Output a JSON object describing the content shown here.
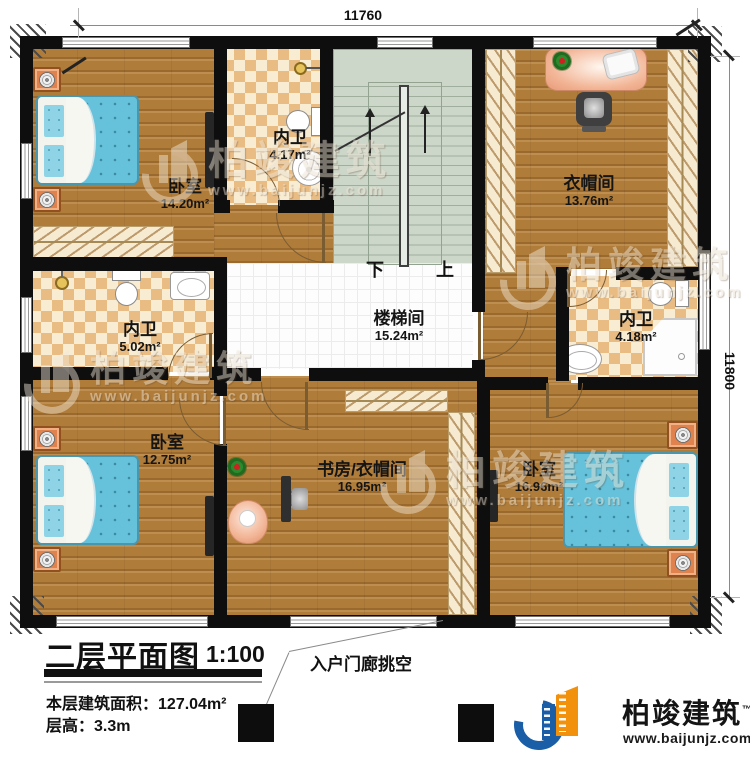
{
  "plan": {
    "title": "二层平面图",
    "scale": "1:100",
    "area_label": "本层建筑面积：",
    "area_value": "127.04m²",
    "floor_height_label": "层高：",
    "floor_height_value": "3.3m",
    "porch_note": "入户门廊挑空",
    "dimensions": {
      "top": "11760",
      "right": "11800"
    },
    "stairs": {
      "down": "下",
      "up": "上"
    },
    "rooms": {
      "bedroom_top_left": {
        "name": "卧室",
        "area": "14.20m²"
      },
      "bath_top": {
        "name": "内卫",
        "area": "4.17m²"
      },
      "cloakroom": {
        "name": "衣帽间",
        "area": "13.76m²"
      },
      "bath_left": {
        "name": "内卫",
        "area": "5.02m²"
      },
      "stair_hall": {
        "name": "楼梯间",
        "area": "15.24m²"
      },
      "bath_right": {
        "name": "内卫",
        "area": "4.18m²"
      },
      "bedroom_bottom_left": {
        "name": "卧室",
        "area": "12.75m²"
      },
      "study_cloakroom": {
        "name": "书房/衣帽间",
        "area": "16.95m²"
      },
      "bedroom_bottom_right": {
        "name": "卧室",
        "area": "16.96m²"
      }
    }
  },
  "watermark": {
    "name": "柏竣建筑",
    "url": "www.baijunjz.com"
  },
  "brand": {
    "name": "柏竣建筑",
    "trademark": "™",
    "url": "www.baijunjz.com"
  },
  "colors": {
    "brand_blue": "#1a5ea8",
    "brand_orange": "#f2920c",
    "wood_floor": "#b07c3a",
    "tile_tan": "#e9bc83",
    "stair_green": "#ccd6c9",
    "bed_blue": "#66c1da",
    "nightstand_orange": "#e0824d"
  }
}
